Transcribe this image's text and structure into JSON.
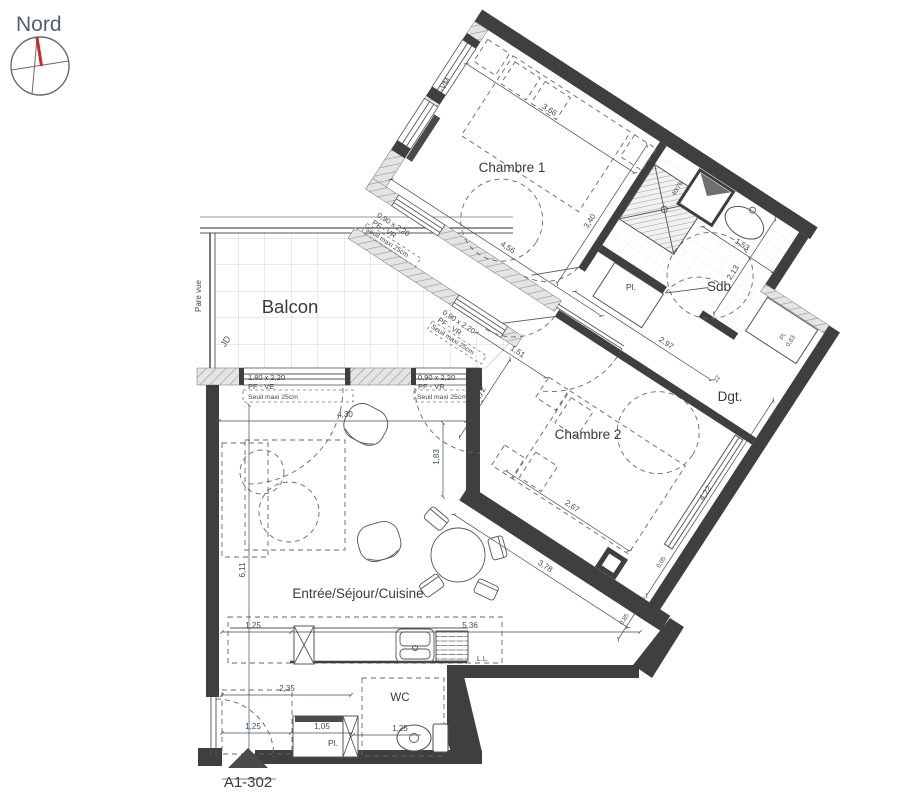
{
  "compass": {
    "label": "Nord"
  },
  "rooms": {
    "chambre1": "Chambre 1",
    "chambre2": "Chambre 2",
    "sdb": "Sdb",
    "dgt": "Dgt.",
    "balcon": "Balcon",
    "sejour": "Entrée/Séjour/Cuisine",
    "wc": "WC",
    "pl_sdb": "Pl.",
    "pl_notch": "Pl.",
    "pl_entry": "Pl."
  },
  "windows": {
    "w1": {
      "size": "1,80 x 2,20",
      "type": "PF - VE",
      "seuil": "Seuil maxi 25cm"
    },
    "w2": {
      "size": "0,90 x 2,20",
      "type": "PF - VR",
      "seuil": "Seuil maxi 25cm"
    },
    "w3": {
      "size": "0,90 x 2,20",
      "type": "PF - VR",
      "seuil": "Seuil maxi 25cm"
    },
    "w4": {
      "size": "0,90 x 2,20",
      "type": "PF - VR",
      "seuil": "Seuil maxi 25cm"
    },
    "fixed": "FA-VM"
  },
  "dims": {
    "d366": "3,66",
    "d340": "3,40",
    "d456": "4,56",
    "d153": "1,53",
    "d213": "2,13",
    "d4076": "40/76",
    "d297": "2,97",
    "d022": "22",
    "d063": "0,63",
    "d151": "1,51",
    "d172": "1,72",
    "d267": "2,67",
    "d378": "3,78",
    "d422": "4,22",
    "d005": "0,05",
    "d085": "0,85",
    "d611": "6,11",
    "d430": "4,30",
    "d183": "1,83",
    "d125a": "1,25",
    "d536": "5,36",
    "d235": "2,35",
    "d125b": "1,25",
    "d105": "1,05",
    "d125c": "1,25",
    "d8014": "80 /14"
  },
  "annotations": {
    "pare_vue": "Pare vue",
    "jd": "JD",
    "ll": "L.L.",
    "door_ref": "A1-302"
  },
  "colors": {
    "wall": "#3f3f3f",
    "dimension_text": "#3d4a63",
    "compass_needle": "#cc2a2a"
  }
}
